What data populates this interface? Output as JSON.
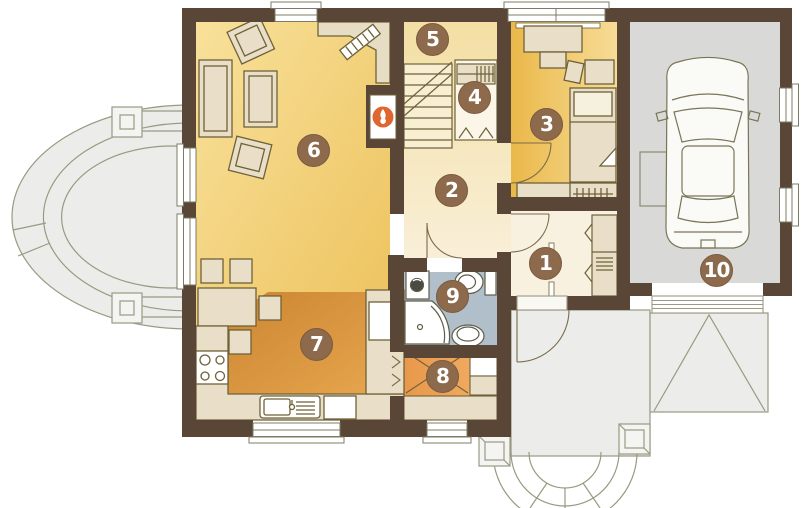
{
  "plan": {
    "badges": [
      {
        "number": "1"
      },
      {
        "number": "2"
      },
      {
        "number": "3"
      },
      {
        "number": "4"
      },
      {
        "number": "5"
      },
      {
        "number": "6"
      },
      {
        "number": "7"
      },
      {
        "number": "8"
      },
      {
        "number": "9"
      },
      {
        "number": "10"
      }
    ],
    "palette": {
      "wall": "#594636",
      "living_floor_light": "#f8e19b",
      "living_floor_dark": "#edc25c",
      "hall_floor_top": "#f3dfa3",
      "hall_floor_bottom": "#f9efd8",
      "bedroom_floor_dark": "#eab84a",
      "bedroom_floor_light": "#f7dc96",
      "entry_floor": "#f8f1df",
      "kitchen_floor_dark": "#c9822e",
      "kitchen_floor_light": "#eaaa52",
      "utility_floor": "#ef9f4e",
      "bathroom_floor": "#b1bfca",
      "garage_floor": "#d9d9d7",
      "outdoor_paving": "#ececea",
      "outdoor_line": "#9a9a82",
      "furniture_fill": "#e9dfc8",
      "furniture_line": "#6f6138",
      "badge_bg": "#8c6a4b",
      "badge_text": "#ffffff",
      "flame_accent": "#e0662f",
      "window_fill": "#ffffff"
    },
    "icons": {
      "flame-icon": "white flame on orange disc (fireplace)",
      "car-icon": "top view car outline (garage)",
      "stove-icon": "four burner circles",
      "sink-icon": "basin with drainer",
      "fridge-icon": "white rectangle in tall unit",
      "toilet-icon": "bowl with cistern",
      "shower-icon": "quarter-circle corner shower",
      "washbasin-icon": "oval basin",
      "washing-machine-icon": "square with drum circle",
      "stairs-icon": "treads with break line",
      "bed-icon": "bed with pillow and folded cover",
      "sofa-icon": "sofa with seat cushion",
      "tv-icon": "hatched rotated rectangle"
    }
  }
}
